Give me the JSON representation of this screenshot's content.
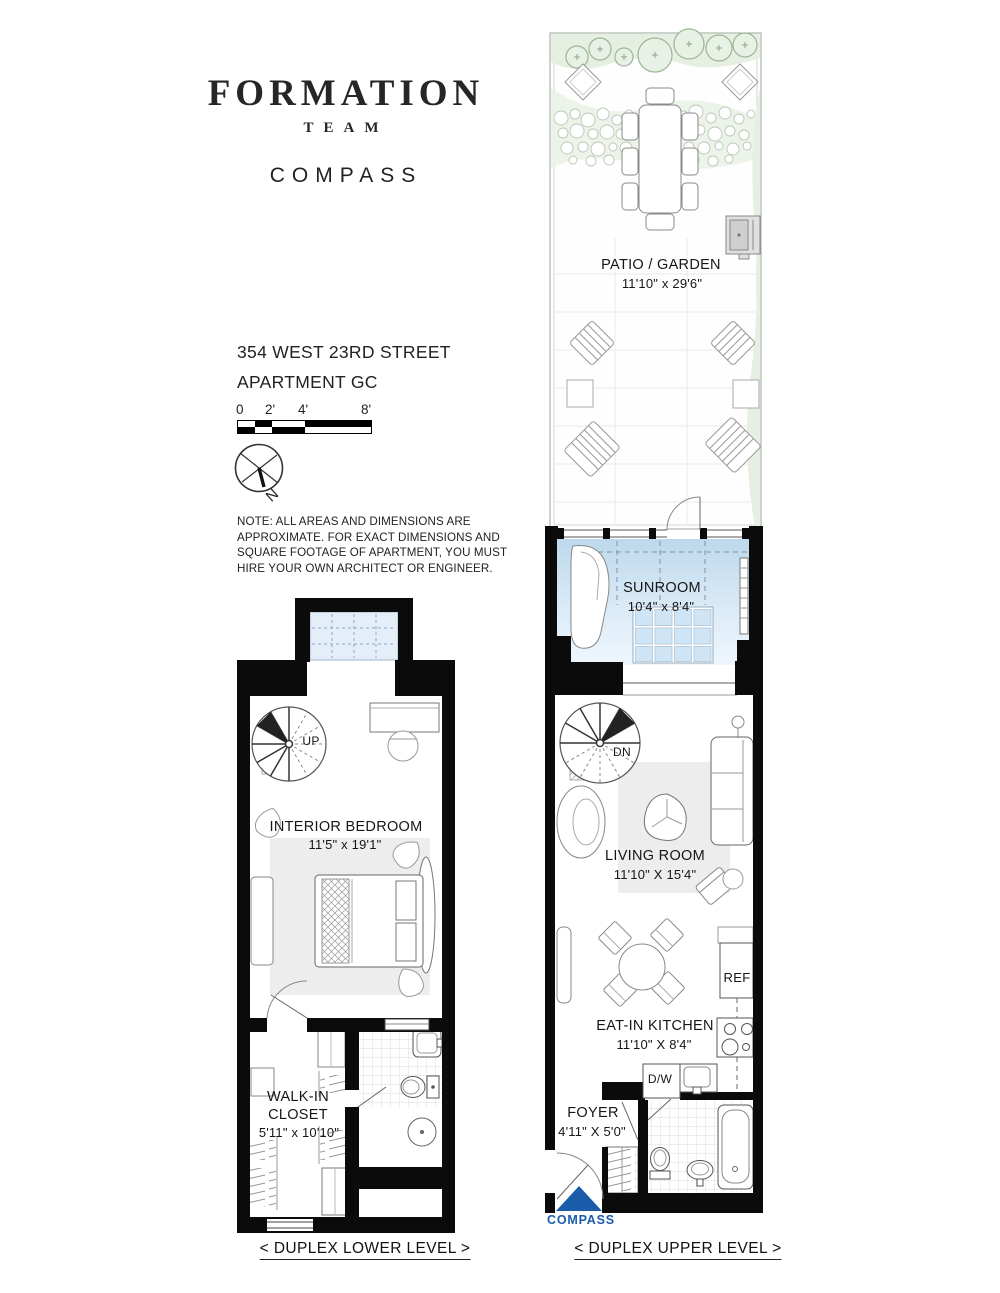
{
  "header": {
    "brand_primary": "FORMATION",
    "brand_secondary": "TEAM",
    "brand_brokerage": "COMPASS"
  },
  "address": {
    "line1": "354 WEST 23RD STREET",
    "line2": "APARTMENT GC"
  },
  "scale_bar": {
    "tick_labels": [
      "0",
      "2'",
      "4'",
      "8'"
    ]
  },
  "compass_rose": {
    "north_label": "N"
  },
  "note": {
    "lines": [
      "NOTE: ALL AREAS AND DIMENSIONS ARE",
      "APPROXIMATE. FOR EXACT DIMENSIONS AND",
      "SQUARE FOOTAGE OF APARTMENT, YOU MUST",
      "HIRE YOUR OWN ARCHITECT OR ENGINEER."
    ]
  },
  "lower_level": {
    "caption": "< DUPLEX LOWER LEVEL >",
    "stair_label": "UP",
    "rooms": {
      "bedroom": {
        "name": "INTERIOR BEDROOM",
        "dims": "11'5\" x 19'1\""
      },
      "closet": {
        "name": "WALK-IN CLOSET",
        "dims": "5'11\" x 10'10\""
      }
    }
  },
  "upper_level": {
    "caption": "< DUPLEX UPPER LEVEL >",
    "stair_label": "DN",
    "rooms": {
      "patio": {
        "name": "PATIO / GARDEN",
        "dims": "11'10\" x 29'6\""
      },
      "sunroom": {
        "name": "SUNROOM",
        "dims": "10'4\" x 8'4\""
      },
      "living": {
        "name": "LIVING ROOM",
        "dims": "11'10\" X 15'4\""
      },
      "kitchen": {
        "name": "EAT-IN KITCHEN",
        "dims": "11'10\" X 8'4\""
      },
      "foyer": {
        "name": "FOYER",
        "dims": "4'11\" X 5'0\""
      }
    },
    "appliances": {
      "refrigerator": "REF",
      "dishwasher": "D/W"
    }
  },
  "footer_logo": {
    "brand": "COMPASS",
    "color": "#1a5caa"
  }
}
